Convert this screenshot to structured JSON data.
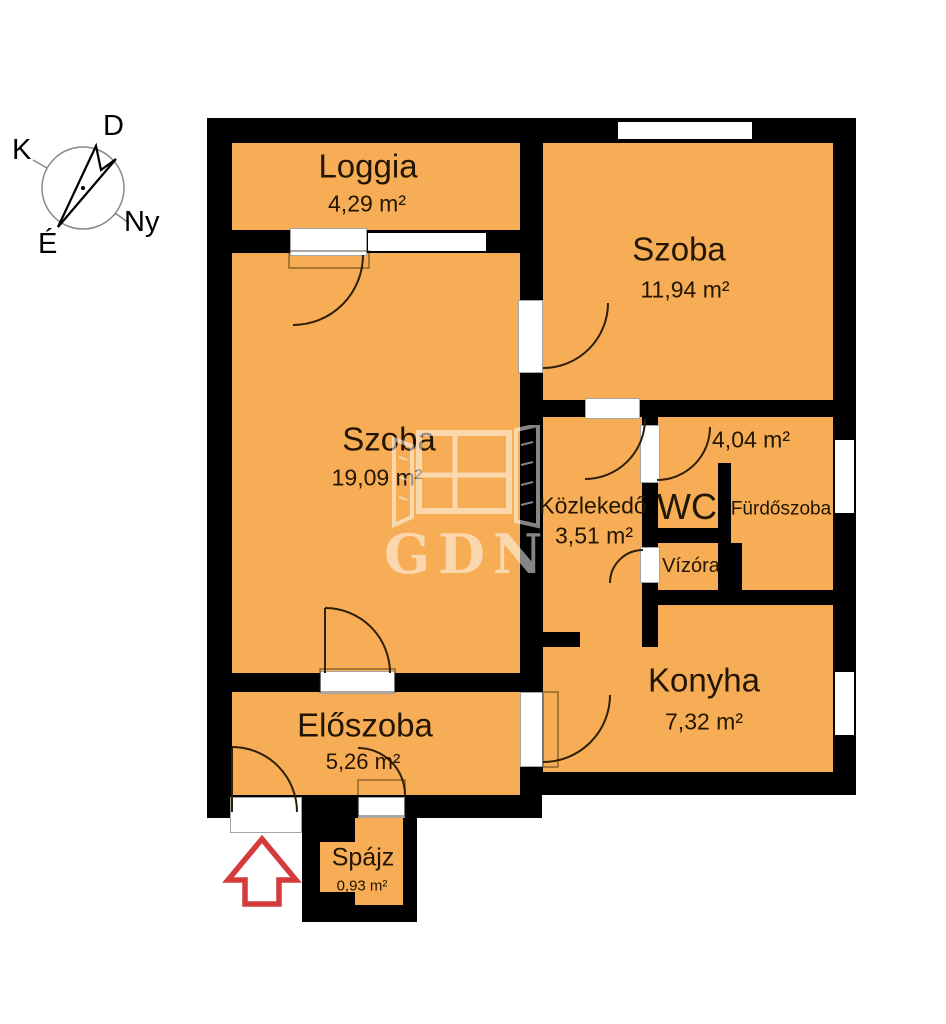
{
  "plan": {
    "rooms": {
      "loggia": {
        "name": "Loggia",
        "area": "4,29 m²"
      },
      "szoba_nagy": {
        "name": "Szoba",
        "area": "19,09 m²"
      },
      "szoba_kis": {
        "name": "Szoba",
        "area": "11,94 m²"
      },
      "kozlekedo": {
        "name": "Közlekedő",
        "area": "3,51 m²"
      },
      "wc": {
        "name": "WC"
      },
      "furdoszoba": {
        "name": "Fürdőszoba",
        "area": "4,04 m²"
      },
      "vizora": {
        "name": "Vízóra"
      },
      "konyha": {
        "name": "Konyha",
        "area": "7,32 m²"
      },
      "eloszoba": {
        "name": "Előszoba",
        "area": "5,26 m²"
      },
      "spajz": {
        "name": "Spájz",
        "area": "0,93 m²"
      }
    },
    "compass": {
      "south": "D",
      "east": "K",
      "north": "É",
      "west": "Ny"
    },
    "watermark": "GDN",
    "colors": {
      "room_fill": "#F6AD55",
      "wall": "#000000",
      "entrance_arrow": "#D43C3C"
    }
  }
}
